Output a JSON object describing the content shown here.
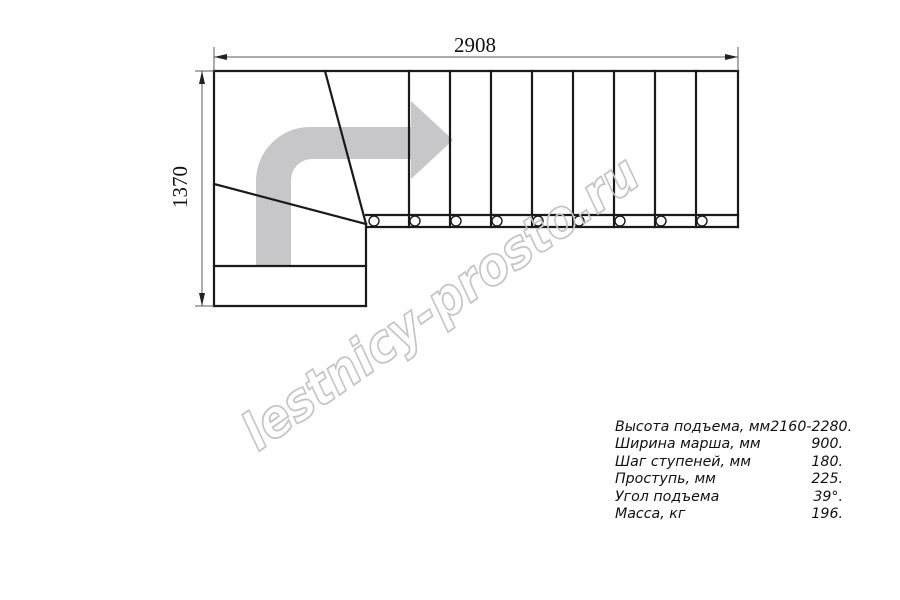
{
  "dimensions": {
    "width_mm": "2908",
    "height_mm": "1370"
  },
  "watermark": {
    "text": "lestnicy-prosto.ru"
  },
  "specs": {
    "rows": [
      {
        "label": "Высота подъема, мм",
        "value": "2160-2280."
      },
      {
        "label": "Ширина марша, мм",
        "value": "900."
      },
      {
        "label": "Шаг ступеней, мм",
        "value": "180."
      },
      {
        "label": "Проступь, мм",
        "value": "225."
      },
      {
        "label": "Угол подъема",
        "value": "39°."
      },
      {
        "label": "Масса, кг",
        "value": "196."
      }
    ]
  },
  "icons": {
    "direction_arrow": "curved-right-direction-arrow"
  },
  "colors": {
    "object_line": "#1a1a1a",
    "dimension_line": "#5a5a5a",
    "arrow_fill": "#c7c7ca",
    "watermark_outline": "#c5c5c5",
    "background": "#ffffff"
  }
}
